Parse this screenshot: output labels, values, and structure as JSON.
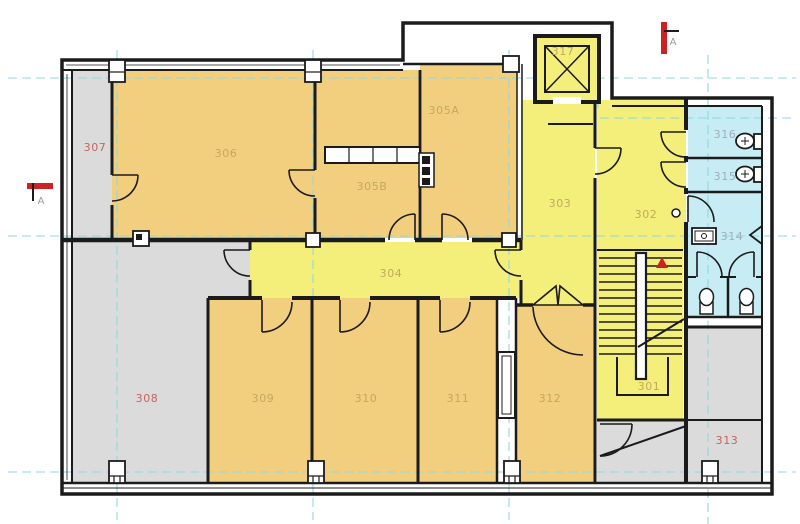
{
  "colors": {
    "background": "#ffffff",
    "wall": "#1b1b1b",
    "room_yellow": "#f3ef7a",
    "room_tan": "#f2cf7e",
    "room_gray": "#dbdbdb",
    "room_blue": "#c7ecf4",
    "grid_cyan": "#8fd9e0",
    "marker_red": "#cc2222",
    "label_olive": "#c2aa5c",
    "label_red": "#c4655f",
    "label_gray_blue": "#9fafb6",
    "label_marker": "#9a9a9a"
  },
  "rooms": {
    "r301": {
      "label": "301"
    },
    "r302": {
      "label": "302"
    },
    "r303": {
      "label": "303"
    },
    "r304": {
      "label": "304"
    },
    "r305A": {
      "label": "305A"
    },
    "r305B": {
      "label": "305B"
    },
    "r306": {
      "label": "306"
    },
    "r307": {
      "label": "307"
    },
    "r308": {
      "label": "308"
    },
    "r309": {
      "label": "309"
    },
    "r310": {
      "label": "310"
    },
    "r311": {
      "label": "311"
    },
    "r312": {
      "label": "312"
    },
    "r313": {
      "label": "313"
    },
    "r314": {
      "label": "314"
    },
    "r315": {
      "label": "315"
    },
    "r316": {
      "label": "316"
    },
    "r317": {
      "label": "317"
    }
  },
  "markers": {
    "section_left_letter": "A",
    "section_top_letter": "A"
  },
  "icons": [
    "elevator-shaft-icon",
    "staircase-icon",
    "toilet-icon",
    "sink-icon",
    "urinal-icon",
    "door-swing-icon",
    "column-marker-icon",
    "section-cut-marker-icon"
  ]
}
